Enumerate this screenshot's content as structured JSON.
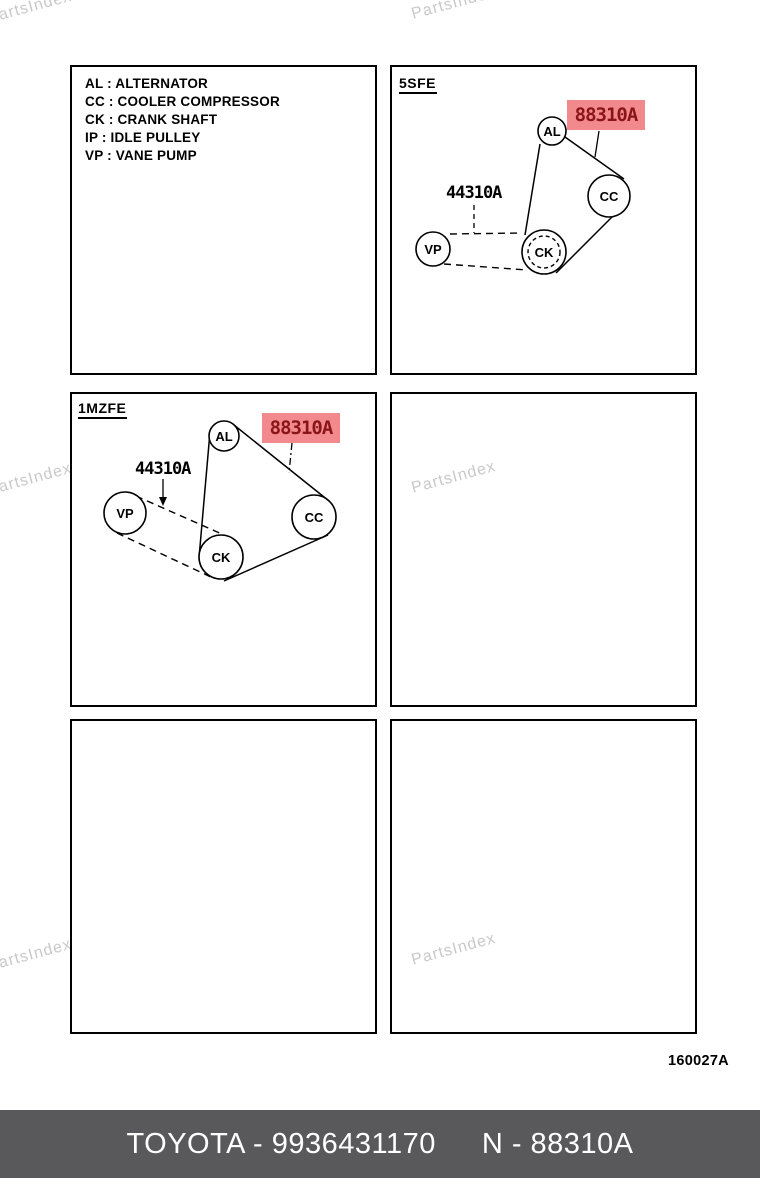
{
  "page": {
    "watermark": "PartsIndex",
    "figure_code": "160027A"
  },
  "colors": {
    "highlight_bg": "#f2898c",
    "highlight_text": "#8a1519",
    "footer_bg": "#59595b",
    "watermark": "#c9c9c9"
  },
  "legend": {
    "items": [
      "AL : ALTERNATOR",
      "CC : COOLER COMPRESSOR",
      "CK : CRANK SHAFT",
      "IP : IDLE PULLEY",
      "VP : VANE PUMP"
    ]
  },
  "diagrams": {
    "d5sfe": {
      "engine": "5SFE",
      "part_label": "44310A",
      "highlighted_part": "88310A",
      "pulleys": {
        "al": "AL",
        "cc": "CC",
        "ck": "CK",
        "vp": "VP"
      }
    },
    "d1mzfe": {
      "engine": "1MZFE",
      "part_label": "44310A",
      "highlighted_part": "88310A",
      "pulleys": {
        "al": "AL",
        "cc": "CC",
        "ck": "CK",
        "vp": "VP"
      }
    }
  },
  "footer": {
    "part_number": "TOYOTA - 9936431170",
    "reference": "N - 88310A"
  }
}
